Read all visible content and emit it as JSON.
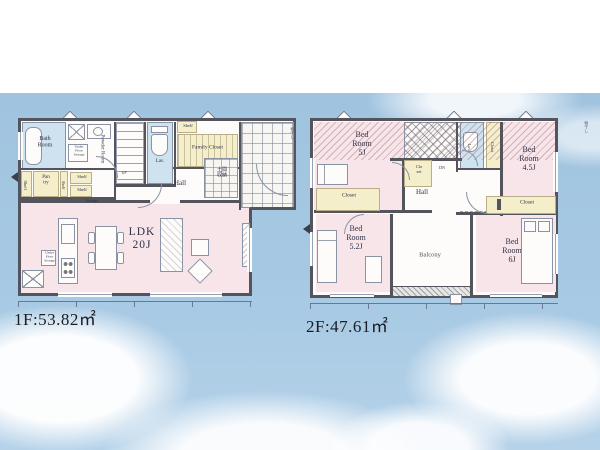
{
  "palette": {
    "sky": "#a5c7e2",
    "wall": "#54555c",
    "room_pink": "#f8e5e9",
    "room_blue": "#cfe2f0",
    "room_yellow": "#f4eecb",
    "line": "#8a93a3",
    "text": "#2e3148"
  },
  "floor1": {
    "area_label": "1F:53.82㎡",
    "labels": {
      "bath": "Bath\nRoom",
      "powder": "Powder Room",
      "under_floor": "Under\nFloor\nStorage",
      "shelf": "Shelf",
      "pantry": "Pan\ntry",
      "storage": "Storage",
      "up": "UP",
      "lav": "Lav.",
      "family_closet": "Family Closet",
      "hall": "Hall",
      "entrance_storage": "土間\n収納",
      "ldk": "LDK\n20J",
      "edge_note": "物干し"
    }
  },
  "floor2": {
    "area_label": "2F:47.61㎡",
    "labels": {
      "bed5": "Bed\nRoom\n5J",
      "bed45": "Bed\nRoom\n4.5J",
      "bed52": "Bed\nRoom\n5.2J",
      "bed6": "Bed\nRoom\n6J",
      "closet": "Closet",
      "closet_small": "Clo\nset",
      "dn": "DN",
      "hall": "Hall",
      "lav": "Lav.",
      "balcony": "Balcony",
      "edge_note": "物干し"
    }
  }
}
